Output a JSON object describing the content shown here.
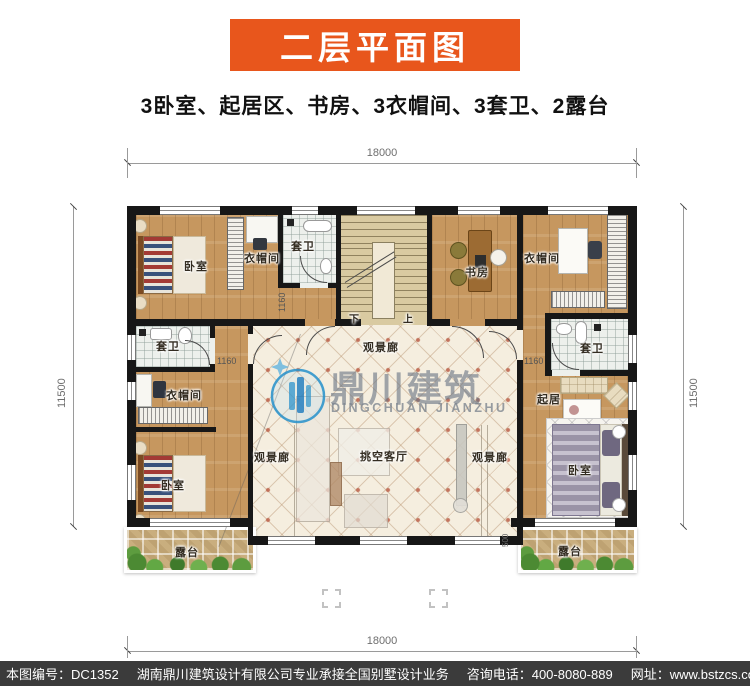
{
  "header": {
    "title": "二层平面图",
    "subtitle": "3卧室、起居区、书房、3衣帽间、3套卫、2露台",
    "title_bg": "#e8561c"
  },
  "rooms": {
    "bedroom": "卧室",
    "cloakroom": "衣帽间",
    "ensuite": "套卫",
    "study": "书房",
    "living": "起居",
    "void_living_room": "挑空客厅",
    "view_gallery": "观景廊",
    "terrace": "露台",
    "up": "上",
    "down": "下"
  },
  "dims": {
    "top": "18000",
    "bottom": "18000",
    "left": "11500",
    "right": "11500",
    "d1160": "1160",
    "d500": "500"
  },
  "watermark": {
    "cn": "鼎川建筑",
    "en": "DINGCHUAN JIANZHU",
    "blue": "#2b93cc"
  },
  "footer": {
    "number": "本图编号：DC1352",
    "company": "湖南鼎川建筑设计有限公司专业承接全国别墅设计业务",
    "phone": "咨询电话：400-8080-889",
    "site": "网址：www.bstzcs.com",
    "bg": "#3b3b3b"
  },
  "colors": {
    "wood": "#c6975f",
    "tile": "#f5eedf",
    "wall": "#171717"
  }
}
